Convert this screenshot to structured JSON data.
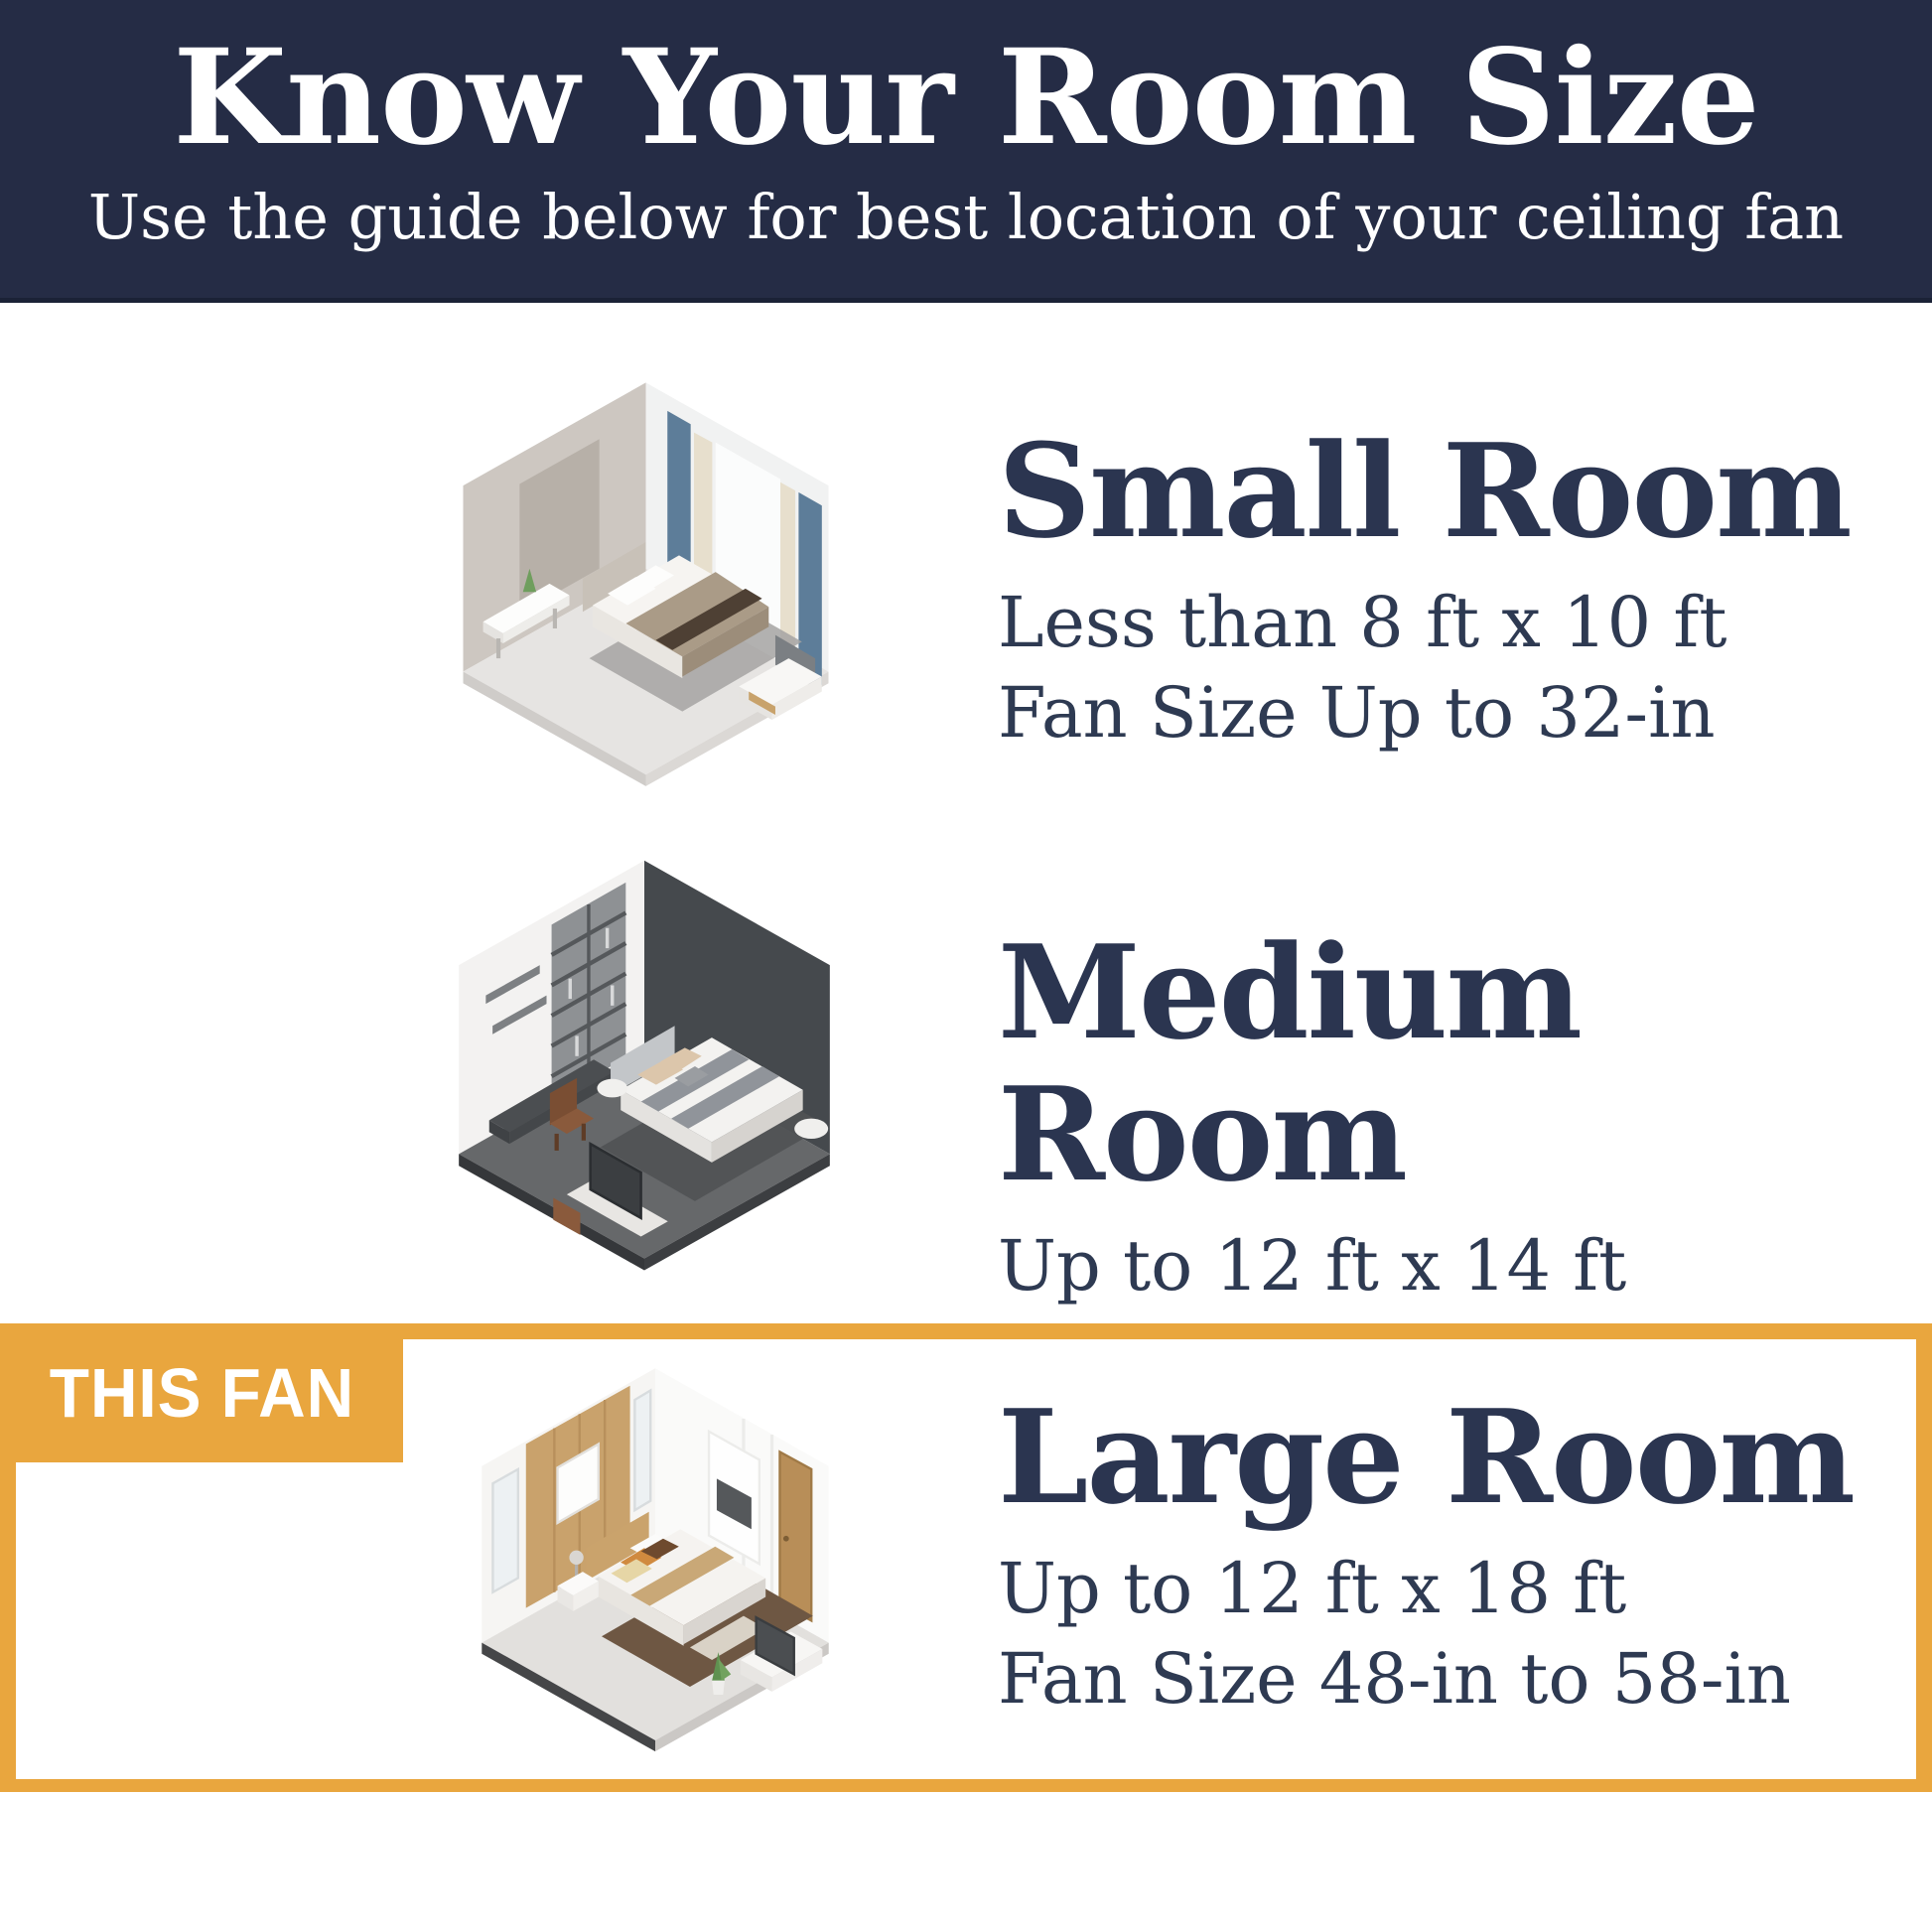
{
  "header": {
    "title": "Know Your Room Size",
    "subtitle": "Use the guide below for best location of your ceiling fan",
    "background_color": "#252c45",
    "text_color": "#ffffff"
  },
  "highlight": {
    "label": "THIS FAN",
    "accent_color": "#e9a63e"
  },
  "sections": [
    {
      "id": "small",
      "title": "Small Room",
      "dimensions": "Less than 8 ft x 10 ft",
      "fan_size": "Fan Size Up to 32-in",
      "illustration": "small-bedroom-isometric-render",
      "highlighted": false
    },
    {
      "id": "medium",
      "title": "Medium Room",
      "dimensions": "Up to 12 ft x 14 ft",
      "fan_size": "Fan Size 32-in to 48-in",
      "illustration": "medium-bedroom-isometric-render",
      "highlighted": false
    },
    {
      "id": "large",
      "title": "Large Room",
      "dimensions": "Up to 12 ft x 18 ft",
      "fan_size": "Fan Size 48-in to 58-in",
      "illustration": "large-bedroom-isometric-render",
      "highlighted": true
    }
  ],
  "colors": {
    "header_navy": "#252c45",
    "accent_orange": "#e9a63e",
    "heading_text": "#2b3550",
    "body_text": "#2e3a52"
  }
}
